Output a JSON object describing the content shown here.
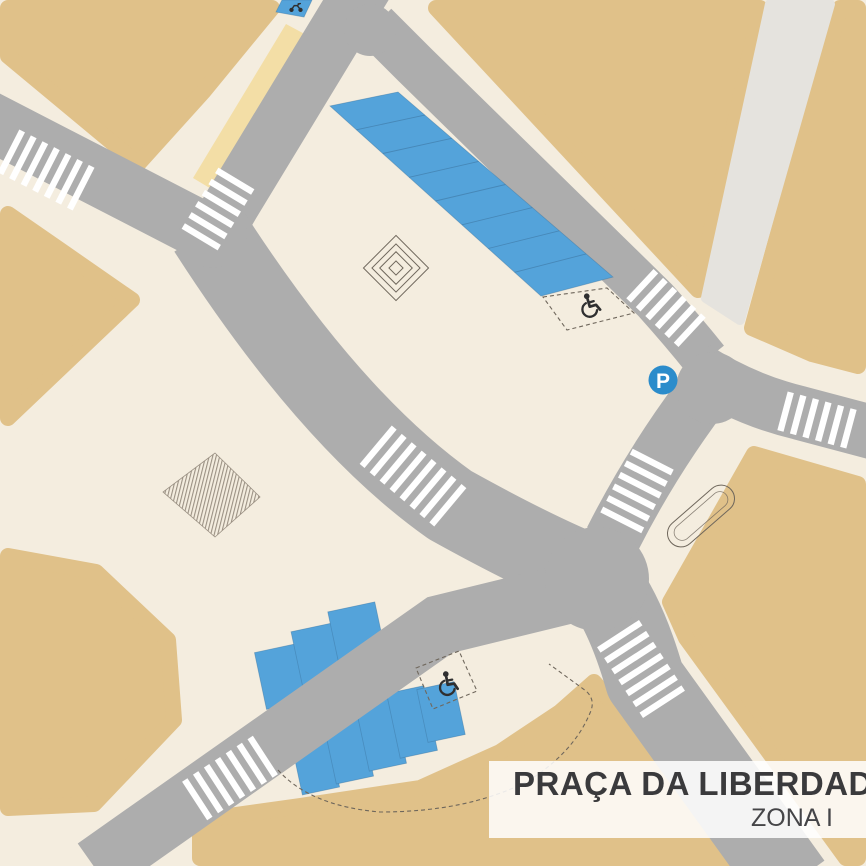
{
  "legend": {
    "title": "PRAÇA DA LIBERDADE",
    "zone": "ZONA I"
  },
  "markers": {
    "parking_sign_label": "P"
  },
  "colors": {
    "cream": "#F4EDDF",
    "tan": "#E0C189",
    "road": "#ADADAD",
    "walkway": "#E5E3DE",
    "sand": "#F3DEA6",
    "blue": "#54A3DA",
    "blue-line": "#3E77A3",
    "p-sign": "#2B8CCB",
    "ink": "#2F2F30",
    "line": "#6F675C",
    "hatch": "#9A9083",
    "stripe": "#FFFFFF",
    "title-text": "#3A3A3C",
    "zone-text": "#454548",
    "legend-bg": "rgba(255,255,255,0.86)"
  }
}
